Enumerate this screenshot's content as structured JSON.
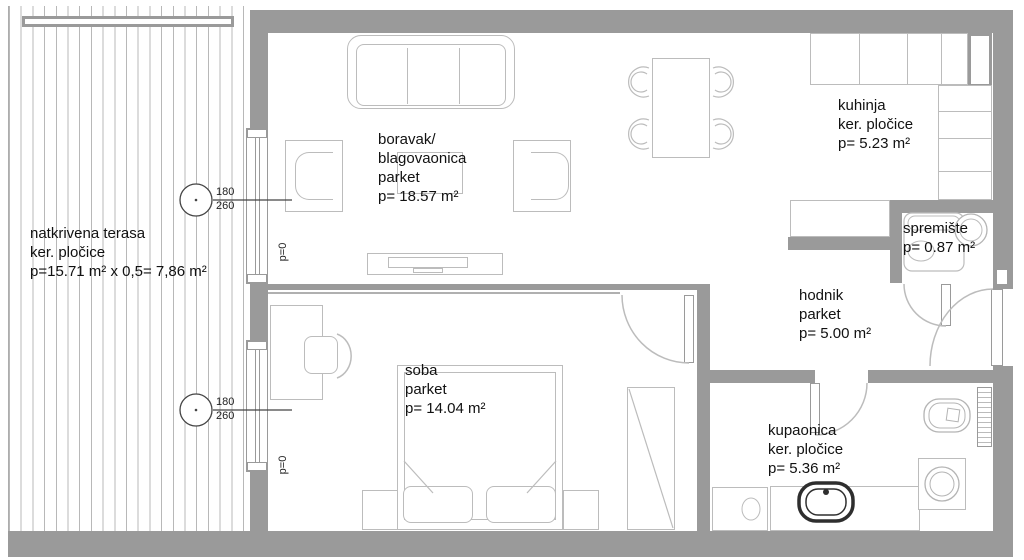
{
  "drawing_type": "apartment floor plan",
  "colors": {
    "wall": "#9a9a9a",
    "furniture_line": "#bcbcbc",
    "marker_line": "#444444",
    "text": "#111111",
    "sink_dark": "#2e2e2e"
  },
  "rooms": {
    "terrace": {
      "lines": [
        "natkrivena terasa",
        "ker. pločice",
        "p=15.71 m² x 0,5= 7,86 m²"
      ]
    },
    "living": {
      "lines": [
        "boravak/",
        "blagovaonica",
        "parket",
        "p= 18.57 m²"
      ]
    },
    "kitchen": {
      "lines": [
        "kuhinja",
        "ker. pločice",
        "p= 5.23 m²"
      ]
    },
    "storage": {
      "lines": [
        "spremište",
        "p= 0.87 m²"
      ]
    },
    "hallway": {
      "lines": [
        "hodnik",
        "parket",
        "p= 5.00 m²"
      ]
    },
    "bedroom": {
      "lines": [
        "soba",
        "parket",
        "p= 14.04 m²"
      ]
    },
    "bathroom": {
      "lines": [
        "kupaonica",
        "ker. pločice",
        "p= 5.36 m²"
      ]
    }
  },
  "window_markers": {
    "width": "180",
    "height": "260"
  },
  "annotations": {
    "parapet": "p=0"
  }
}
